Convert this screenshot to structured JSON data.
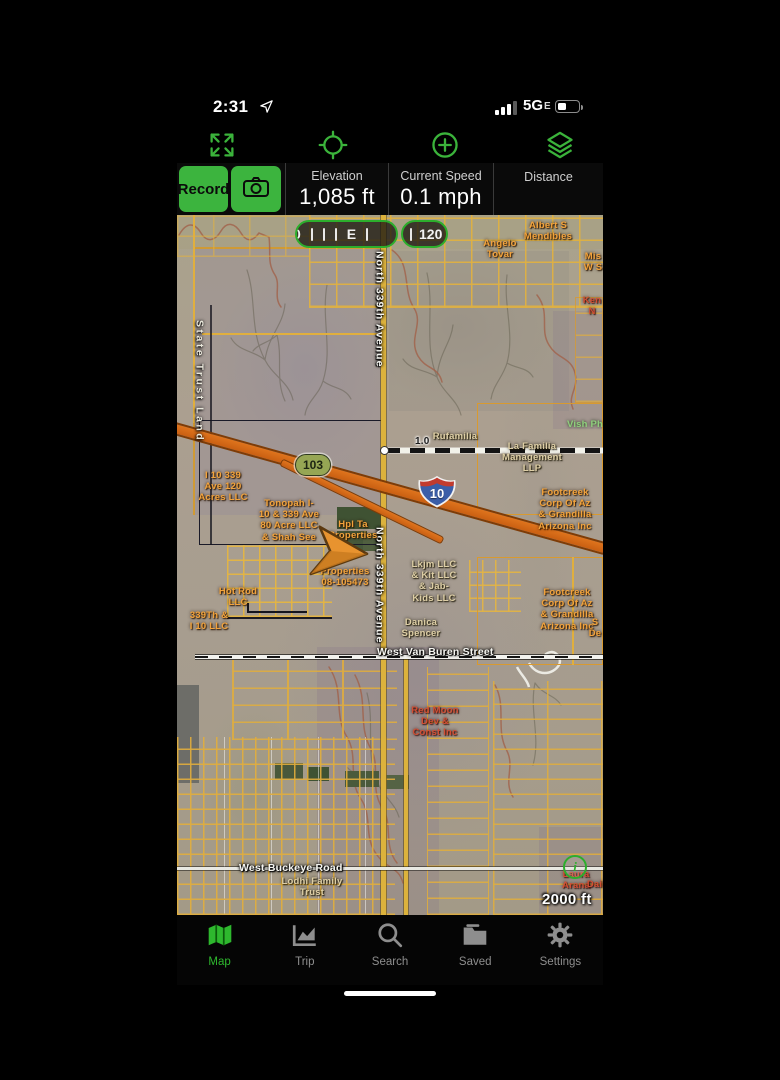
{
  "status_bar": {
    "time": "2:31",
    "network": "5G",
    "network_sub": "E"
  },
  "record_bar": {
    "record_label": "Record",
    "stats": [
      {
        "label": "Elevation",
        "value": "1,085 ft"
      },
      {
        "label": "Current Speed",
        "value": "0.1 mph"
      },
      {
        "label": "Distance",
        "value": ""
      }
    ]
  },
  "compass_tape": {
    "partial_left": "0",
    "heading_letter": "E",
    "heading_value": "120"
  },
  "map": {
    "route_shield": "103",
    "interstate_shield": "10",
    "distance_marker": "1.0",
    "scale_label": "2000 ft",
    "info_glyph": "i",
    "labels": [
      {
        "text": "State Trust Land",
        "style": "area-vert",
        "x": 16,
        "y": 105,
        "name": "label-state-trust-land"
      },
      {
        "text": "North 339th Avenue",
        "style": "road-vert",
        "x": 196,
        "y": 36,
        "name": "label-north-339th-avenue"
      },
      {
        "text": "North 339th Avenue",
        "style": "road-vert",
        "x": 196,
        "y": 312,
        "name": "label-north-339th-avenue"
      },
      {
        "text": "West Van Buren Street",
        "style": "road-h",
        "x": 200,
        "y": 431,
        "name": "label-west-van-buren-street"
      },
      {
        "text": "West Buckeye Road",
        "style": "road-h",
        "x": 62,
        "y": 647,
        "name": "label-west-buckeye-road"
      },
      {
        "text": "Angelo\nTovar",
        "style": "orange",
        "x": 295,
        "y": 23,
        "w": 56
      },
      {
        "text": "Albert S\nMendibles",
        "style": "orange",
        "x": 337,
        "y": 5,
        "w": 68
      },
      {
        "text": "Mis\nW S",
        "style": "orange",
        "x": 396,
        "y": 36,
        "w": 40
      },
      {
        "text": "I 10 339\nAve 120\nAcres LLC",
        "style": "orange",
        "x": 15,
        "y": 255,
        "w": 62
      },
      {
        "text": "Tonopah I-\n10 & 339 Ave\n80 Acre LLC\n& Shah See",
        "style": "orange",
        "x": 75,
        "y": 283,
        "w": 74
      },
      {
        "text": "Hpl Ta\nProperties",
        "style": "orange",
        "x": 147,
        "y": 304,
        "w": 58
      },
      {
        "text": "Properties\n08-105473",
        "style": "orange",
        "x": 133,
        "y": 351,
        "w": 70
      },
      {
        "text": "Hot Rod\nLLC",
        "style": "orange",
        "x": 33,
        "y": 371,
        "w": 56
      },
      {
        "text": "339Th &\nI 10 LLC",
        "style": "orange",
        "x": 4,
        "y": 395,
        "w": 56
      },
      {
        "text": "Footcreek\nCorp Of Az\n& Grandilla\nArizona Inc",
        "style": "orange",
        "x": 355,
        "y": 272,
        "w": 66
      },
      {
        "text": "Footcreek\nCorp Of Az\n& Grandilla\nArizona Inc",
        "style": "orange",
        "x": 357,
        "y": 372,
        "w": 66
      },
      {
        "text": "La Familia\nManagement\nLLP",
        "style": "tan",
        "x": 322,
        "y": 226,
        "w": 66
      },
      {
        "text": "Lkjm LLC\n& Kit LLC\n& Jab-\nKids LLC",
        "style": "tan",
        "x": 224,
        "y": 344,
        "w": 66
      },
      {
        "text": "Danica\nSpencer",
        "style": "tan",
        "x": 216,
        "y": 402,
        "w": 56
      },
      {
        "text": "Rufamilia",
        "style": "tan",
        "x": 250,
        "y": 216,
        "w": 56
      },
      {
        "text": "Red Moon\nDev &\nConst Inc",
        "style": "red",
        "x": 225,
        "y": 490,
        "w": 66
      },
      {
        "text": "Lodhi Family\nTrust",
        "style": "tan",
        "x": 100,
        "y": 661,
        "w": 70
      },
      {
        "text": "Laura\nArana",
        "style": "red",
        "x": 378,
        "y": 654,
        "w": 42
      },
      {
        "text": "Dail",
        "style": "red",
        "x": 407,
        "y": 664,
        "w": 24
      },
      {
        "text": "Vish Ph",
        "style": "green",
        "x": 388,
        "y": 204,
        "w": 40
      },
      {
        "text": "Ken\nN",
        "style": "red",
        "x": 400,
        "y": 80,
        "w": 30
      },
      {
        "text": "S\nDe",
        "style": "orange",
        "x": 406,
        "y": 402,
        "w": 24
      }
    ]
  },
  "tab_bar": {
    "items": [
      {
        "label": "Map",
        "active": true
      },
      {
        "label": "Trip",
        "active": false
      },
      {
        "label": "Search",
        "active": false
      },
      {
        "label": "Saved",
        "active": false
      },
      {
        "label": "Settings",
        "active": false
      }
    ]
  }
}
